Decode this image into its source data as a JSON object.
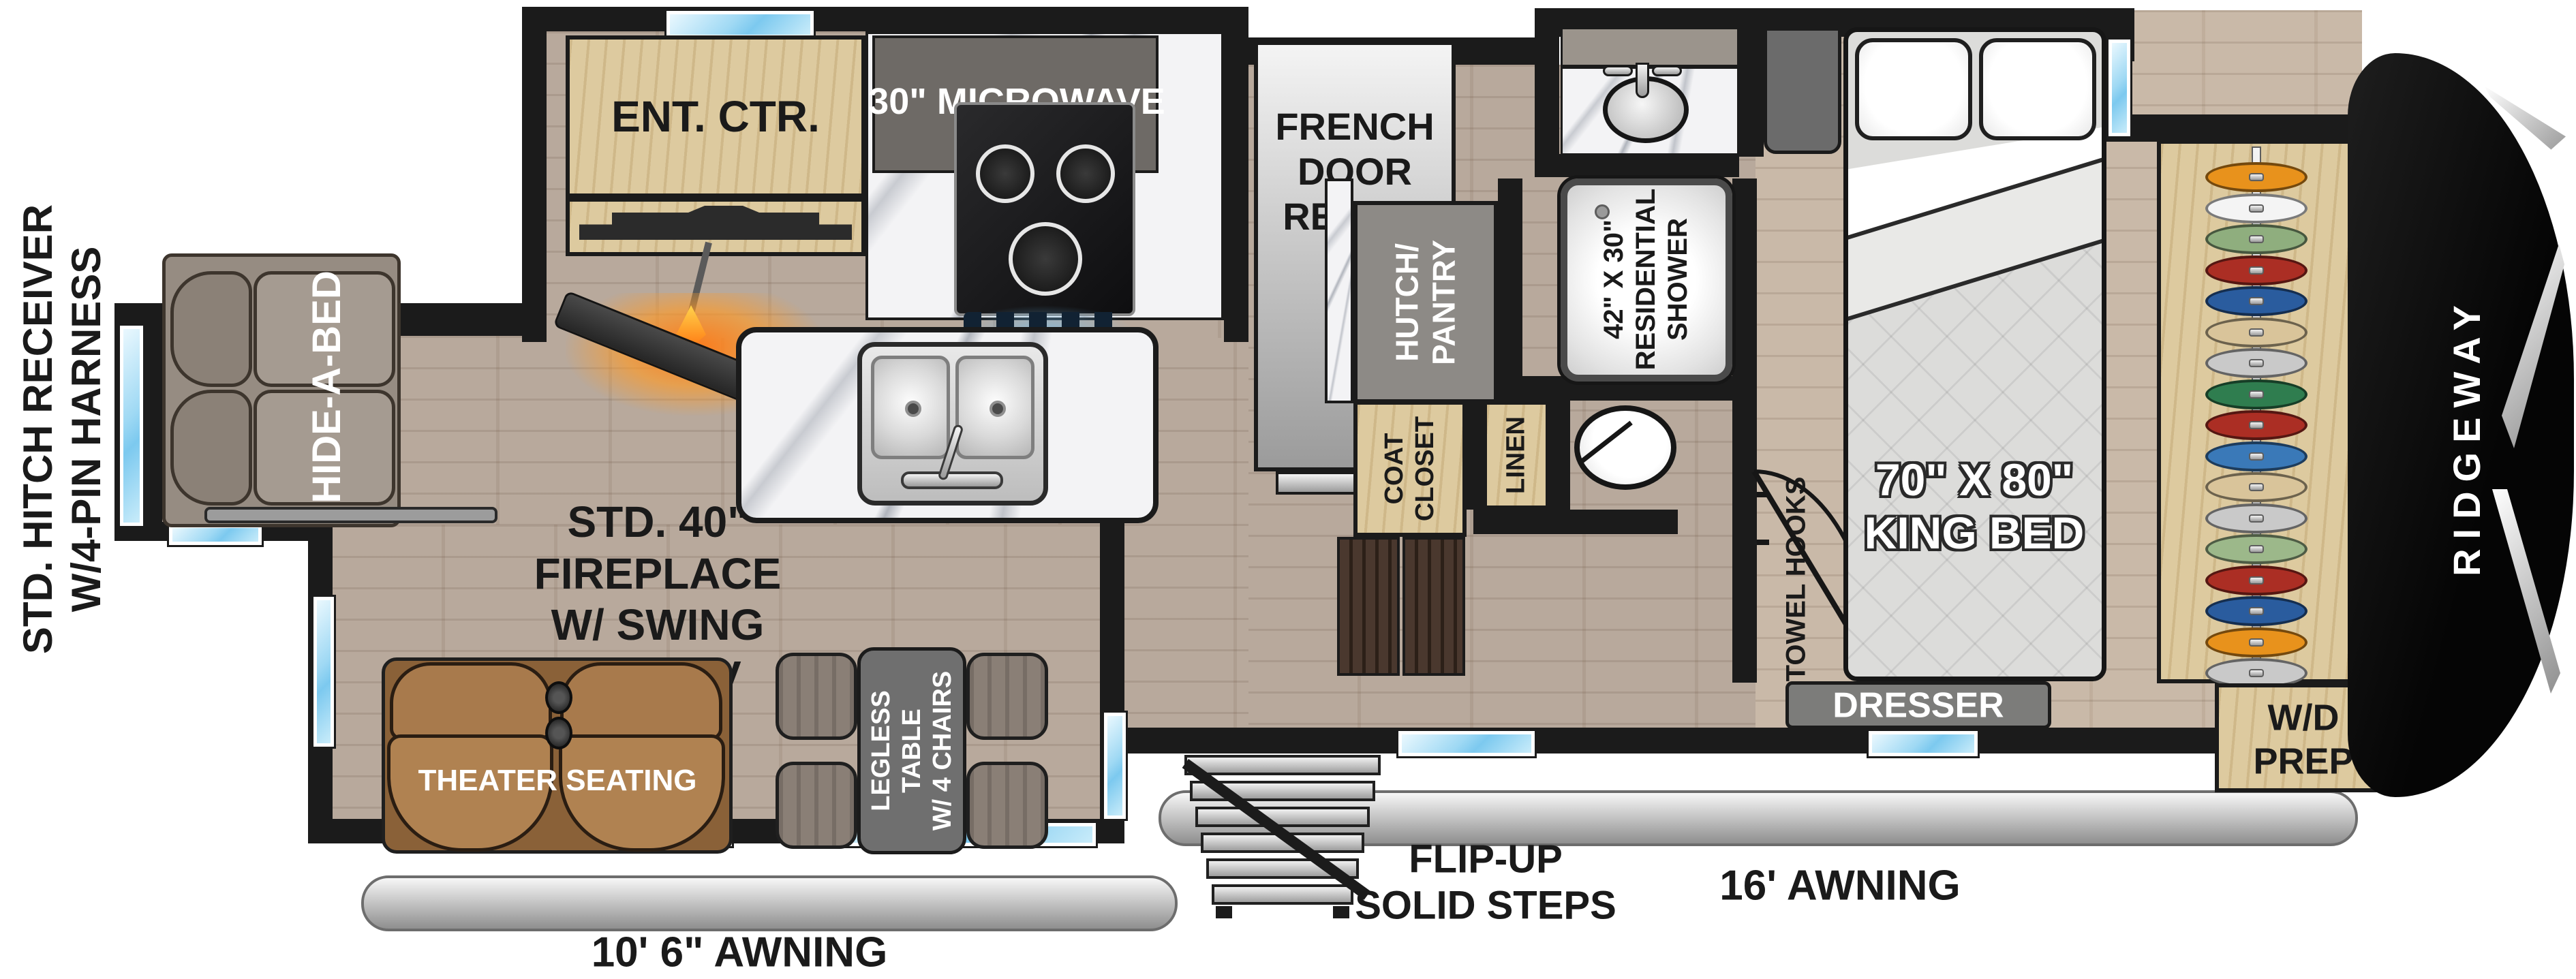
{
  "palette": {
    "wall": "#1b1b1b",
    "window_blue": "#7cc9ef",
    "floor_main": "#b4a496",
    "floor_bedroom": "#c6b5a3",
    "fireplace_glow": "#ff9a26",
    "cap_black": "#121212",
    "tan_wood": "#ddca9f",
    "sofa_taupe": "#968c82",
    "theater_brown": "#a87a4c",
    "fridge_silver": "#d8d8d8"
  },
  "labels": {
    "hitch": {
      "line1": "STD. HITCH RECEIVER",
      "line2": "W/4-PIN HARNESS"
    },
    "ent_ctr": "ENT. CTR.",
    "microwave": "30\" MICROWAVE",
    "oven": "21\" OVEN",
    "fridge": {
      "line1": "FRENCH",
      "line2": "DOOR",
      "line3": "REFRIG"
    },
    "fireplace": {
      "line1": "STD. 40\"",
      "line2": "FIREPLACE",
      "line3": "W/ SWING",
      "line4": "ARM TV"
    },
    "hide_a_bed": "HIDE-A-BED",
    "hutch": {
      "line1": "HUTCH/",
      "line2": "PANTRY"
    },
    "shower": {
      "line1": "42\" X 30\"",
      "line2": "RESIDENTIAL",
      "line3": "SHOWER"
    },
    "coat_closet": {
      "line1": "COAT",
      "line2": "CLOSET"
    },
    "linen": "LINEN",
    "towel_hooks": "TOWEL HOOKS",
    "king_bed": {
      "line1": "70\" X 80\"",
      "line2": "KING BED"
    },
    "dresser": "DRESSER",
    "wd_prep": {
      "line1": "W/D",
      "line2": "PREP"
    },
    "ridgeway": "RIDGEWAY",
    "theater": "THEATER SEATING",
    "table": {
      "line1": "LEGLESS",
      "line2": "TABLE",
      "line3": "W/ 4 CHAIRS"
    },
    "flip_steps": {
      "line1": "FLIP-UP",
      "line2": "SOLID STEPS"
    },
    "awning_16": "16' AWNING",
    "awning_106": "10' 6\" AWNING"
  },
  "wardrobe": {
    "hangers": [
      "#e8921c",
      "#f4f4f4",
      "#8fae7e",
      "#ab2e24",
      "#2a5c9e",
      "#d9c49a",
      "#c9c9c9",
      "#2f7d4f",
      "#ab2e24",
      "#3a79b8",
      "#d9c49a",
      "#c9c9c9",
      "#9cb88a",
      "#ab2e24",
      "#2a5c9e",
      "#e8921c",
      "#c9c9c9"
    ]
  }
}
